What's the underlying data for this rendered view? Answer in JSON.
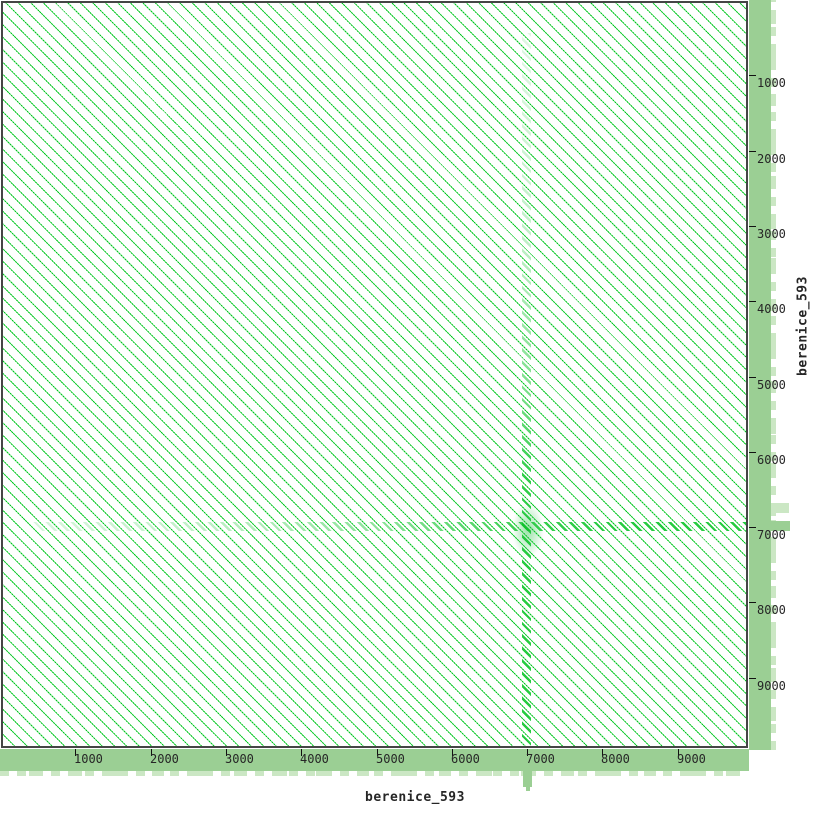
{
  "axes": {
    "x": {
      "label": "berenice_593",
      "ticks": [
        1000,
        2000,
        3000,
        4000,
        5000,
        6000,
        7000,
        8000,
        9000
      ]
    },
    "y": {
      "label": "berenice_593",
      "ticks": [
        1000,
        2000,
        3000,
        4000,
        5000,
        6000,
        7000,
        8000,
        9000
      ]
    }
  },
  "chart_data": {
    "type": "heatmap",
    "description": "Nucleotide dot plot of sequence berenice_593 against itself; dense parallel diagonal match lines indicate a tandem repeat covering the whole sequence",
    "xlabel": "berenice_593",
    "ylabel": "berenice_593",
    "x_ticks": [
      1000,
      2000,
      3000,
      4000,
      5000,
      6000,
      7000,
      8000,
      9000
    ],
    "y_ticks": [
      1000,
      2000,
      3000,
      4000,
      5000,
      6000,
      7000,
      8000,
      9000
    ],
    "x_range": [
      0,
      9900
    ],
    "y_range": [
      0,
      9900
    ],
    "grid": false,
    "legend": "none",
    "diagonal_direction": "top-left to bottom-right",
    "diagonal_period_bp": 165,
    "features": [
      {
        "kind": "vertical-streak",
        "x": 7000,
        "note": "denser matches fading toward top"
      },
      {
        "kind": "horizontal-streak",
        "y": 7000,
        "note": "denser matches fading toward left"
      },
      {
        "kind": "bottom-profile-spike",
        "x": 7000
      },
      {
        "kind": "right-profile-spike",
        "y": 7000
      }
    ],
    "colors": {
      "line_green": "#00c71e",
      "band_green": "#9bcf94",
      "band_green_light": "#cbe7c4",
      "border_gray": "#454545",
      "text_dark": "#262626"
    }
  }
}
